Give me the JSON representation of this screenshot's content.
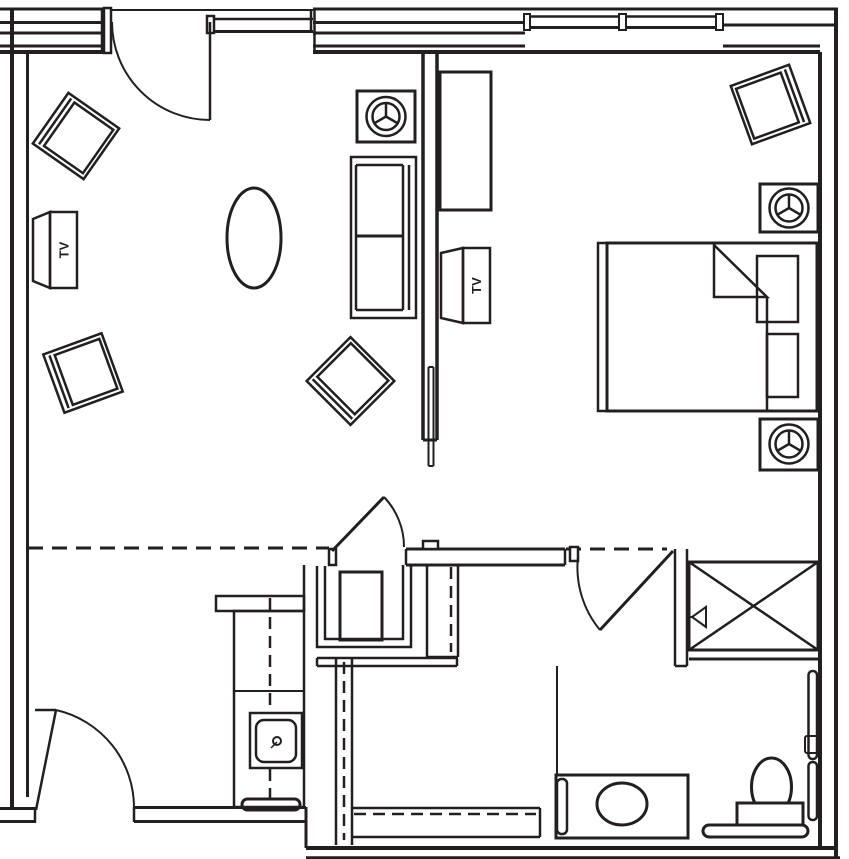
{
  "meta": {
    "title": "Apartment unit floor plan",
    "drawing_type": "architectural line drawing, black on white"
  },
  "colors": {
    "line": "#231f20",
    "background": "#ffffff"
  },
  "labels": {
    "tv": "TV"
  },
  "rooms": [
    {
      "name": "living-area",
      "furniture": [
        "armchair-top-left",
        "armchair-mid-left",
        "accent-chair-rotated",
        "sofa",
        "oval-coffee-table",
        "tv-cabinet-on-left-wall",
        "lamp-table"
      ]
    },
    {
      "name": "bedroom",
      "furniture": [
        "bed-with-two-pillows-and-folded-blanket",
        "nightstand-with-lamp-upper",
        "nightstand-with-lamp-lower",
        "dresser-console",
        "tv-cabinet-on-partition",
        "corner-armchair"
      ]
    },
    {
      "name": "bathroom",
      "furniture": [
        "vanity-with-oval-sink",
        "toilet-with-tank",
        "horizontal-grab-bar",
        "vertical-grab-bars",
        "x-marked-closet-unit"
      ]
    },
    {
      "name": "kitchenette",
      "furniture": [
        "counter-with-dashed-upper-cabinets",
        "square-sink-with-drain",
        "towel-bar"
      ]
    },
    {
      "name": "entry-closet",
      "furniture": [
        "water-heater-box"
      ]
    }
  ],
  "icons": {
    "table-lamp": "double circle with three spokes",
    "door-swing": "quarter arc",
    "closet-x": "crossed diagonals",
    "sink-drain": "small circle",
    "window": "parallel glazing lines with mullion ticks"
  },
  "doors": [
    "top-entry-door",
    "bottom-left-entry-door",
    "hall-closet-door",
    "bedroom-bathroom-door"
  ],
  "windows": [
    "top-left-window",
    "top-middle-window",
    "top-center-window-triple"
  ],
  "dashed_lines": [
    "living-area-ceiling-break",
    "bedroom-opening-header",
    "kitchen-upper-cabinet-line",
    "bathroom-wall-lines"
  ]
}
